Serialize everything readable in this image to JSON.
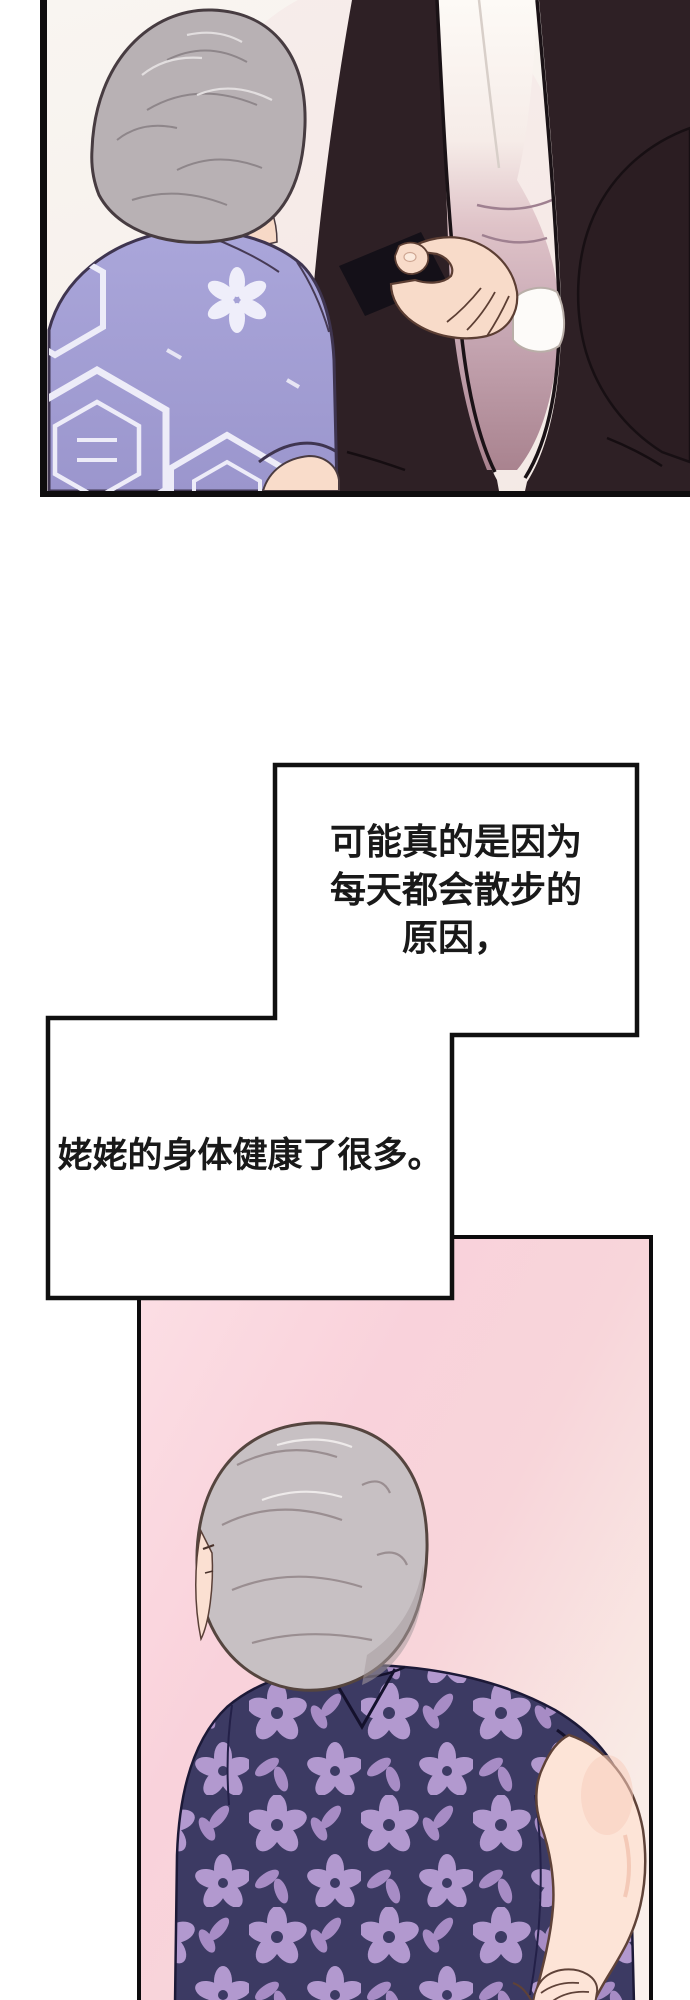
{
  "page": {
    "kind": "webtoon-comic-page",
    "language": "zh"
  },
  "panel1": {
    "alt": "Elderly gray-haired woman in lavender patterned shirt beside a man in a dark suit holding a black card"
  },
  "speech": {
    "bubble1": {
      "line1": "可能真的是因为",
      "line2": "每天都会散步的",
      "line3": "原因，"
    },
    "bubble2": {
      "line": "姥姥的身体健康了很多。"
    }
  },
  "panel3": {
    "alt": "Elderly woman seen from behind in navy floral shirt, hands clasped behind her back, pink background"
  },
  "palette": {
    "panel_border": "#0f0d0e",
    "speech_fill": "#ffffff",
    "text_color": "#191919",
    "suit": "#2e2025",
    "inner_shirt_mauve": "#c9aab6",
    "lavender_shirt": "#a3a0d5",
    "pattern_white": "#edecf8",
    "hair_gray": "#b8b1b4",
    "hair_gray_light": "#c7c0c3",
    "skin": "#f8dbc9",
    "card_black": "#141018",
    "navy_shirt": "#3c3a63",
    "flower_lilac": "#b299cf",
    "pink_bg_top": "#fcdfe5",
    "pink_bg_deep": "#f8cfd8",
    "pink_bg_fade": "#faf2ee"
  }
}
